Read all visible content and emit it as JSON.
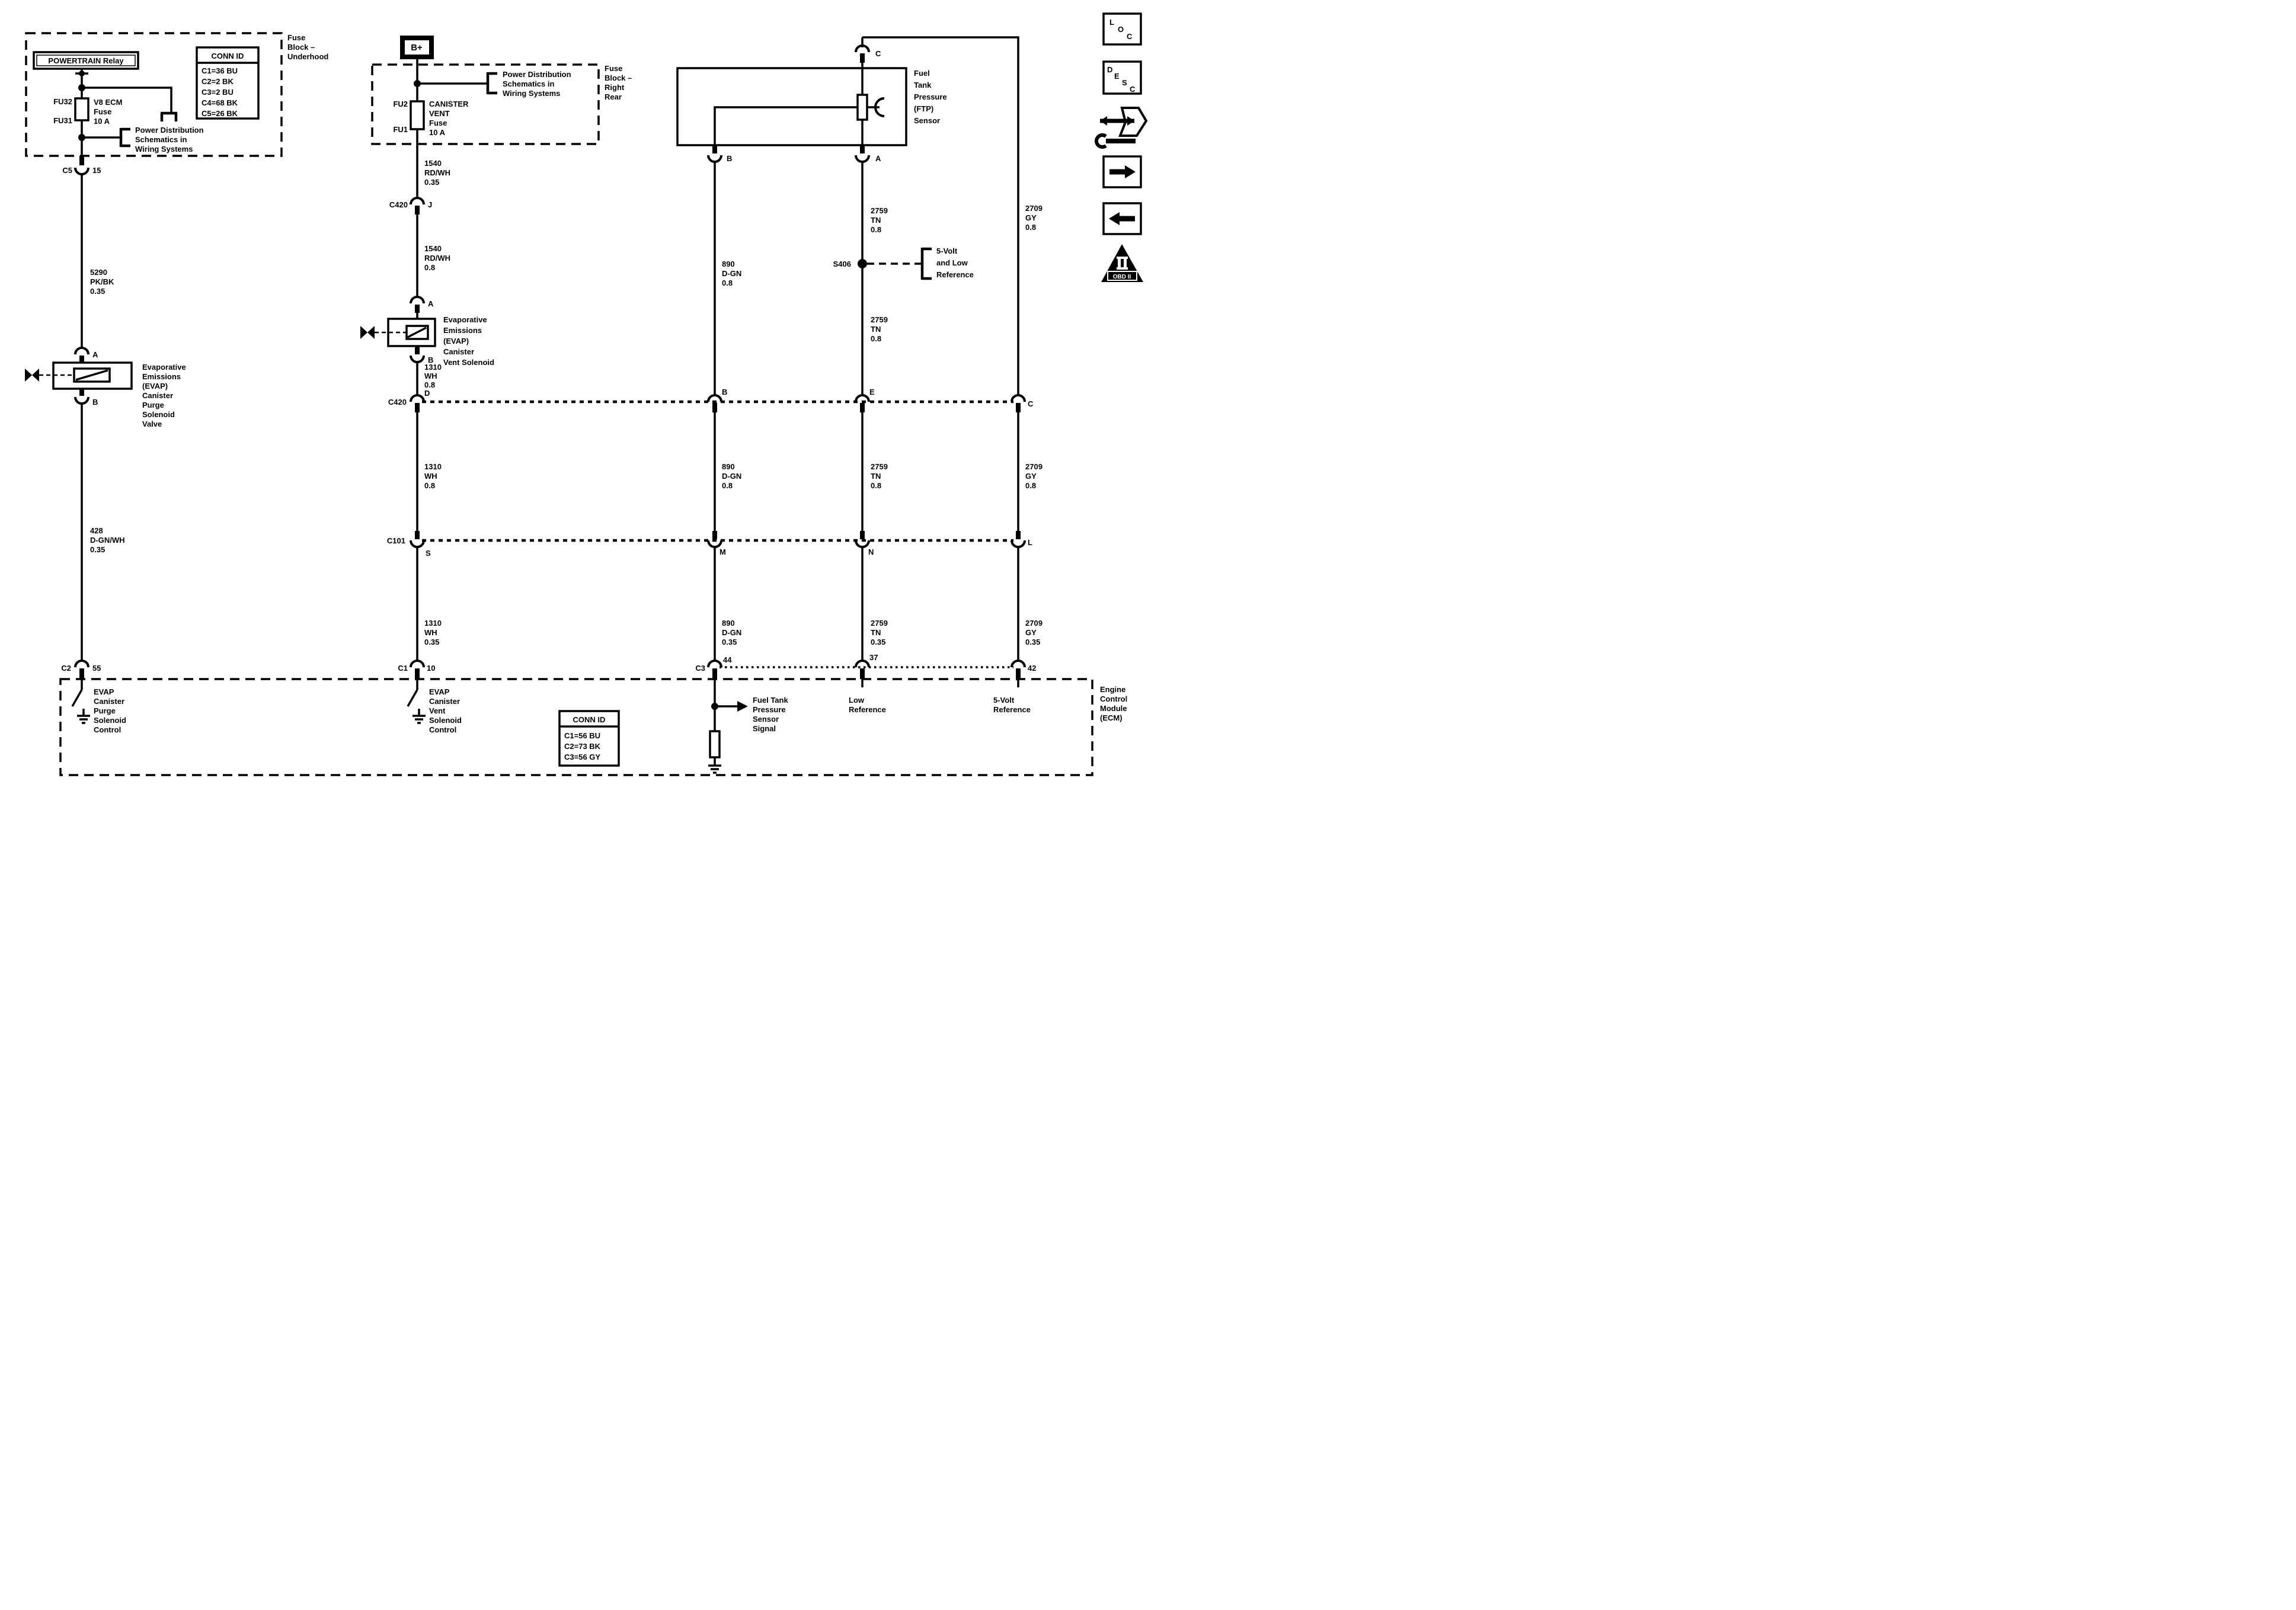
{
  "colors": {
    "ink": "#000000",
    "paper": "#ffffff"
  },
  "shared": {
    "power_dist": [
      "Power Distribution",
      "Schematics in",
      "Wiring Systems"
    ]
  },
  "blocks": {
    "underhood": {
      "title": [
        "Fuse",
        "Block –",
        "Underhood"
      ],
      "relay": "POWERTRAIN Relay",
      "conn_id": {
        "title": "CONN ID",
        "rows": [
          "C1=36 BU",
          "C2=2 BK",
          "C3=2 BU",
          "C4=68 BK",
          "C5=26 BK"
        ]
      },
      "fuse_top": "FU32",
      "fuse_bottom": "FU31",
      "fuse_name": [
        "V8 ECM",
        "Fuse",
        "10 A"
      ],
      "out_conn": {
        "name": "C5",
        "pin": "15"
      }
    },
    "right_rear": {
      "title": [
        "Fuse",
        "Block –",
        "Right",
        "Rear"
      ],
      "battery": "B+",
      "fuse_top": "FU2",
      "fuse_bottom": "FU1",
      "fuse_name": [
        "CANISTER",
        "VENT",
        "Fuse",
        "10 A"
      ]
    }
  },
  "circuits": {
    "purge": {
      "w5290": [
        "5290",
        "PK/BK",
        "0.35"
      ],
      "pin_a": "A",
      "pin_b": "B",
      "solenoid": [
        "Evaporative",
        "Emissions",
        "(EVAP)",
        "Canister",
        "Purge",
        "Solenoid",
        "Valve"
      ],
      "w428": [
        "428",
        "D-GN/WH",
        "0.35"
      ],
      "conn": {
        "name": "C2",
        "pin": "55"
      },
      "ecm_fn": [
        "EVAP",
        "Canister",
        "Purge",
        "Solenoid",
        "Control"
      ]
    },
    "vent": {
      "w1540a": [
        "1540",
        "RD/WH",
        "0.35"
      ],
      "conn_j": {
        "name": "C420",
        "pin": "J"
      },
      "w1540b": [
        "1540",
        "RD/WH",
        "0.8"
      ],
      "pin_a": "A",
      "pin_b": "B",
      "solenoid": [
        "Evaporative",
        "Emissions",
        "(EVAP)",
        "Canister",
        "Vent Solenoid"
      ],
      "w1310a": [
        "1310",
        "WH",
        "0.8"
      ],
      "w1310b": [
        "1310",
        "WH",
        "0.8"
      ],
      "w1310c": [
        "1310",
        "WH",
        "0.35"
      ],
      "conn": {
        "name": "C1",
        "pin": "10"
      },
      "ecm_fn": [
        "EVAP",
        "Canister",
        "Vent",
        "Solenoid",
        "Control"
      ]
    },
    "ftp": {
      "label": [
        "Fuel",
        "Tank",
        "Pressure",
        "(FTP)",
        "Sensor"
      ],
      "pin_c": "C",
      "pin_b": "B",
      "pin_a": "A",
      "w890a": [
        "890",
        "D-GN",
        "0.8"
      ],
      "w890b": [
        "890",
        "D-GN",
        "0.8"
      ],
      "w890c": [
        "890",
        "D-GN",
        "0.35"
      ],
      "w2759a": [
        "2759",
        "TN",
        "0.8"
      ],
      "w2759b": [
        "2759",
        "TN",
        "0.8"
      ],
      "w2759c": [
        "2759",
        "TN",
        "0.8"
      ],
      "w2759d": [
        "2759",
        "TN",
        "0.35"
      ],
      "w2709a": [
        "2709",
        "GY",
        "0.8"
      ],
      "w2709b": [
        "2709",
        "GY",
        "0.8"
      ],
      "w2709c": [
        "2709",
        "GY",
        "0.35"
      ],
      "splice": {
        "name": "S406",
        "ref": [
          "5-Volt",
          "and Low",
          "Reference"
        ]
      }
    }
  },
  "rows": {
    "c420": {
      "name": "C420",
      "pins": [
        "D",
        "B",
        "E",
        "C"
      ]
    },
    "c101": {
      "name": "C101",
      "pins": [
        "S",
        "M",
        "N",
        "L"
      ]
    },
    "c3": {
      "name": "C3",
      "pins": [
        "44",
        "37",
        "42"
      ]
    }
  },
  "ecm": {
    "label": [
      "Engine",
      "Control",
      "Module",
      "(ECM)"
    ],
    "signal": [
      "Fuel Tank",
      "Pressure",
      "Sensor",
      "Signal"
    ],
    "low_ref": [
      "Low",
      "Reference"
    ],
    "five_v_ref": [
      "5-Volt",
      "Reference"
    ],
    "conn_id": {
      "title": "CONN ID",
      "rows": [
        "C1=56 BU",
        "C2=73 BK",
        "C3=56 GY"
      ]
    }
  },
  "sidebar": {
    "loc": [
      "L",
      "O",
      "C"
    ],
    "desc": [
      "D",
      "E",
      "S",
      "C"
    ],
    "obd": "OBD II"
  }
}
